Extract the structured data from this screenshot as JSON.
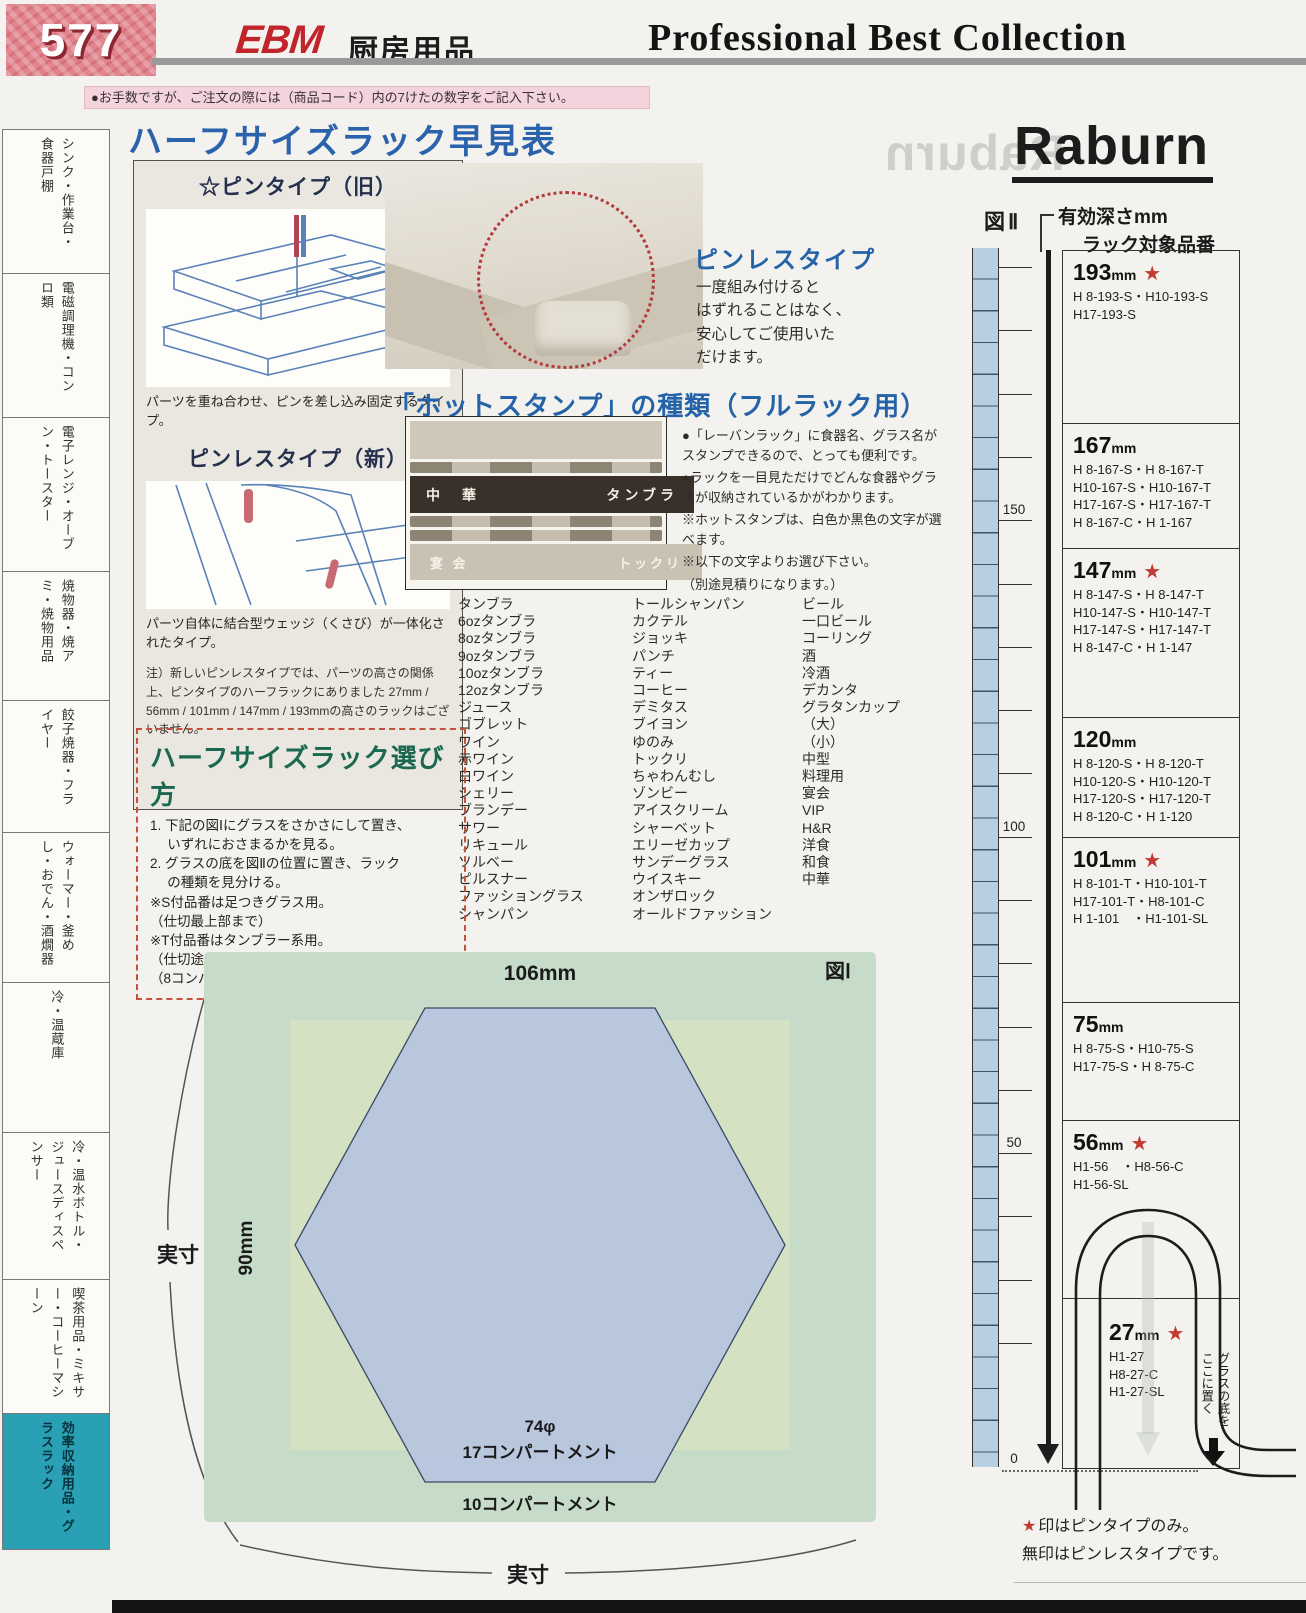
{
  "page": {
    "number": "577",
    "brand": "EBM",
    "brand_suffix": "厨房用品",
    "collection": "Professional Best Collection",
    "order_note": "●お手数ですが、ご注文の際には（商品コード）内の7けたの数字をご記入下さい。",
    "maker_logo": "Raburn",
    "accent_colors": {
      "heading_blue": "#2563a8",
      "star_red": "#c23b33",
      "sidebar_teal": "#2aa0b5",
      "erabikata_green": "#1b6851"
    }
  },
  "sidebar": {
    "items": [
      {
        "label": "シンク・作業台・食器戸棚",
        "active": false
      },
      {
        "label": "電磁調理機・コンロ類",
        "active": false
      },
      {
        "label": "電子レンジ・オーブン・トースター",
        "active": false
      },
      {
        "label": "焼物器・焼アミ・焼物用品",
        "active": false
      },
      {
        "label": "餃子焼器・フライヤー",
        "active": false
      },
      {
        "label": "ウォーマー・釜めし・おでん・酒燗器",
        "active": false
      },
      {
        "label": "冷・温蔵庫",
        "active": false
      },
      {
        "label": "冷・温水ボトル・ジュースディスペンサー",
        "active": false
      },
      {
        "label": "喫茶用品・ミキサー・コーヒーマシーン",
        "active": false
      },
      {
        "label": "効率収納用品・グラスラック",
        "active": true
      }
    ]
  },
  "quick_table": {
    "title": "ハーフサイズラック早見表"
  },
  "pin_panel": {
    "old_heading": "☆ピンタイプ（旧）",
    "old_caption": "パーツを重ね合わせ、ピンを差し込み固定するタイプ。",
    "new_heading": "ピンレスタイプ（新）",
    "new_caption": "パーツ自体に結合型ウェッジ（くさび）が一体化されたタイプ。",
    "note": "注）新しいピンレスタイプでは、パーツの高さの関係上、ピンタイプのハーフラックにありました 27mm / 56mm / 101mm / 147mm / 193mmの高さのラックはございません。"
  },
  "pinless": {
    "heading": "ピンレスタイプ",
    "body": "一度組み付けると\nはずれることはなく、\n安心してご使用いた\nだけます。"
  },
  "hotstamp": {
    "heading": "「ホットスタンプ」の種類（フルラック用）",
    "photo_labels": {
      "left_top": "中　華",
      "right_top": "タンブラ",
      "left_bottom": "宴 会",
      "right_bottom": "トックリ"
    },
    "bullets": [
      "●「レーバンラック」に食器名、グラス名がスタンプできるので、とっても便利です。",
      "●ラックを一目見ただけでどんな食器やグラスが収納されているかがわかります。",
      "※ホットスタンプは、白色か黒色の文字が選べます。",
      "※以下の文字よりお選び下さい。",
      "（別途見積りになります。）"
    ]
  },
  "glass_names": {
    "col1": [
      "タンブラ",
      "6ozタンブラ",
      "8ozタンブラ",
      "9ozタンブラ",
      "10ozタンブラ",
      "12ozタンブラ",
      "ジュース",
      "ゴブレット",
      "ワイン",
      "赤ワイン",
      "白ワイン",
      "シェリー",
      "ブランデー",
      "サワー",
      "リキュール",
      "ソルベー",
      "ピルスナー",
      "ファッショングラス",
      "シャンパン"
    ],
    "col2": [
      "トールシャンパン",
      "カクテル",
      "ジョッキ",
      "パンチ",
      "ティー",
      "コーヒー",
      "デミタス",
      "ブイヨン",
      "ゆのみ",
      "トックリ",
      "ちゃわんむし",
      "ゾンビー",
      "アイスクリーム",
      "シャーベット",
      "エリーゼカップ",
      "サンデーグラス",
      "ウイスキー",
      "オンザロック",
      "オールドファッション"
    ],
    "col3": [
      "ビール",
      "一口ビール",
      "コーリング",
      "酒",
      "冷酒",
      "デカンタ",
      "グラタンカップ",
      "（大）",
      "（小）",
      "中型",
      "料理用",
      "宴会",
      "VIP",
      "H&R",
      "洋食",
      "和食",
      "中華"
    ]
  },
  "erabikata": {
    "heading": "ハーフサイズラック選び方",
    "lines": [
      "1. 下記の図Ⅰにグラスをさかさにして置き、",
      "　 いずれにおさまるかを見る。",
      "2. グラスの底を図Ⅱの位置に置き、ラック",
      "　 の種類を見分ける。",
      "※S付品番は足つきグラス用。",
      "（仕切最上部まで）",
      "※T付品番はタンブラー系用。",
      "（仕切途中まで）",
      "（8コンパートメントは106mm×114mm角です。）"
    ]
  },
  "fig1": {
    "label": "図Ⅰ",
    "width_label": "106mm",
    "height_label": "90mm",
    "actual_size_left": "実寸",
    "actual_size_bottom": "実寸",
    "hex_diameter": "74φ",
    "hex_compartments": "17コンパートメント",
    "outer_compartments": "10コンパートメント"
  },
  "fig2": {
    "label": "図Ⅱ",
    "depth_heading": "有効深さmm",
    "rack_heading": "ラック対象品番",
    "scale_labels": [
      "150",
      "100",
      "50",
      "0"
    ],
    "glass_note": "グラスの底を\nここに置く",
    "sections": [
      {
        "value": "193",
        "unit": "mm",
        "star": true,
        "codes": [
          "H 8-193-S・H10-193-S",
          "H17-193-S"
        ]
      },
      {
        "value": "167",
        "unit": "mm",
        "star": false,
        "codes": [
          "H 8-167-S・H 8-167-T",
          "H10-167-S・H10-167-T",
          "H17-167-S・H17-167-T",
          "H 8-167-C・H 1-167"
        ]
      },
      {
        "value": "147",
        "unit": "mm",
        "star": true,
        "codes": [
          "H 8-147-S・H 8-147-T",
          "H10-147-S・H10-147-T",
          "H17-147-S・H17-147-T",
          "H 8-147-C・H 1-147"
        ]
      },
      {
        "value": "120",
        "unit": "mm",
        "star": false,
        "codes": [
          "H 8-120-S・H 8-120-T",
          "H10-120-S・H10-120-T",
          "H17-120-S・H17-120-T",
          "H 8-120-C・H 1-120"
        ]
      },
      {
        "value": "101",
        "unit": "mm",
        "star": true,
        "codes": [
          "H 8-101-T・H10-101-T",
          "H17-101-T・H8-101-C",
          "H 1-101　・H1-101-SL"
        ]
      },
      {
        "value": "75",
        "unit": "mm",
        "star": false,
        "codes": [
          "H 8-75-S・H10-75-S",
          "H17-75-S・H 8-75-C"
        ]
      },
      {
        "value": "56",
        "unit": "mm",
        "star": true,
        "codes": [
          "H1-56　・H8-56-C",
          "H1-56-SL"
        ]
      },
      {
        "value": "27",
        "unit": "mm",
        "star": true,
        "codes": [
          "H1-27",
          "H8-27-C",
          "H1-27-SL"
        ]
      }
    ],
    "footnote1": "印はピンタイプのみ。",
    "footnote2": "無印はピンレスタイプです。"
  }
}
